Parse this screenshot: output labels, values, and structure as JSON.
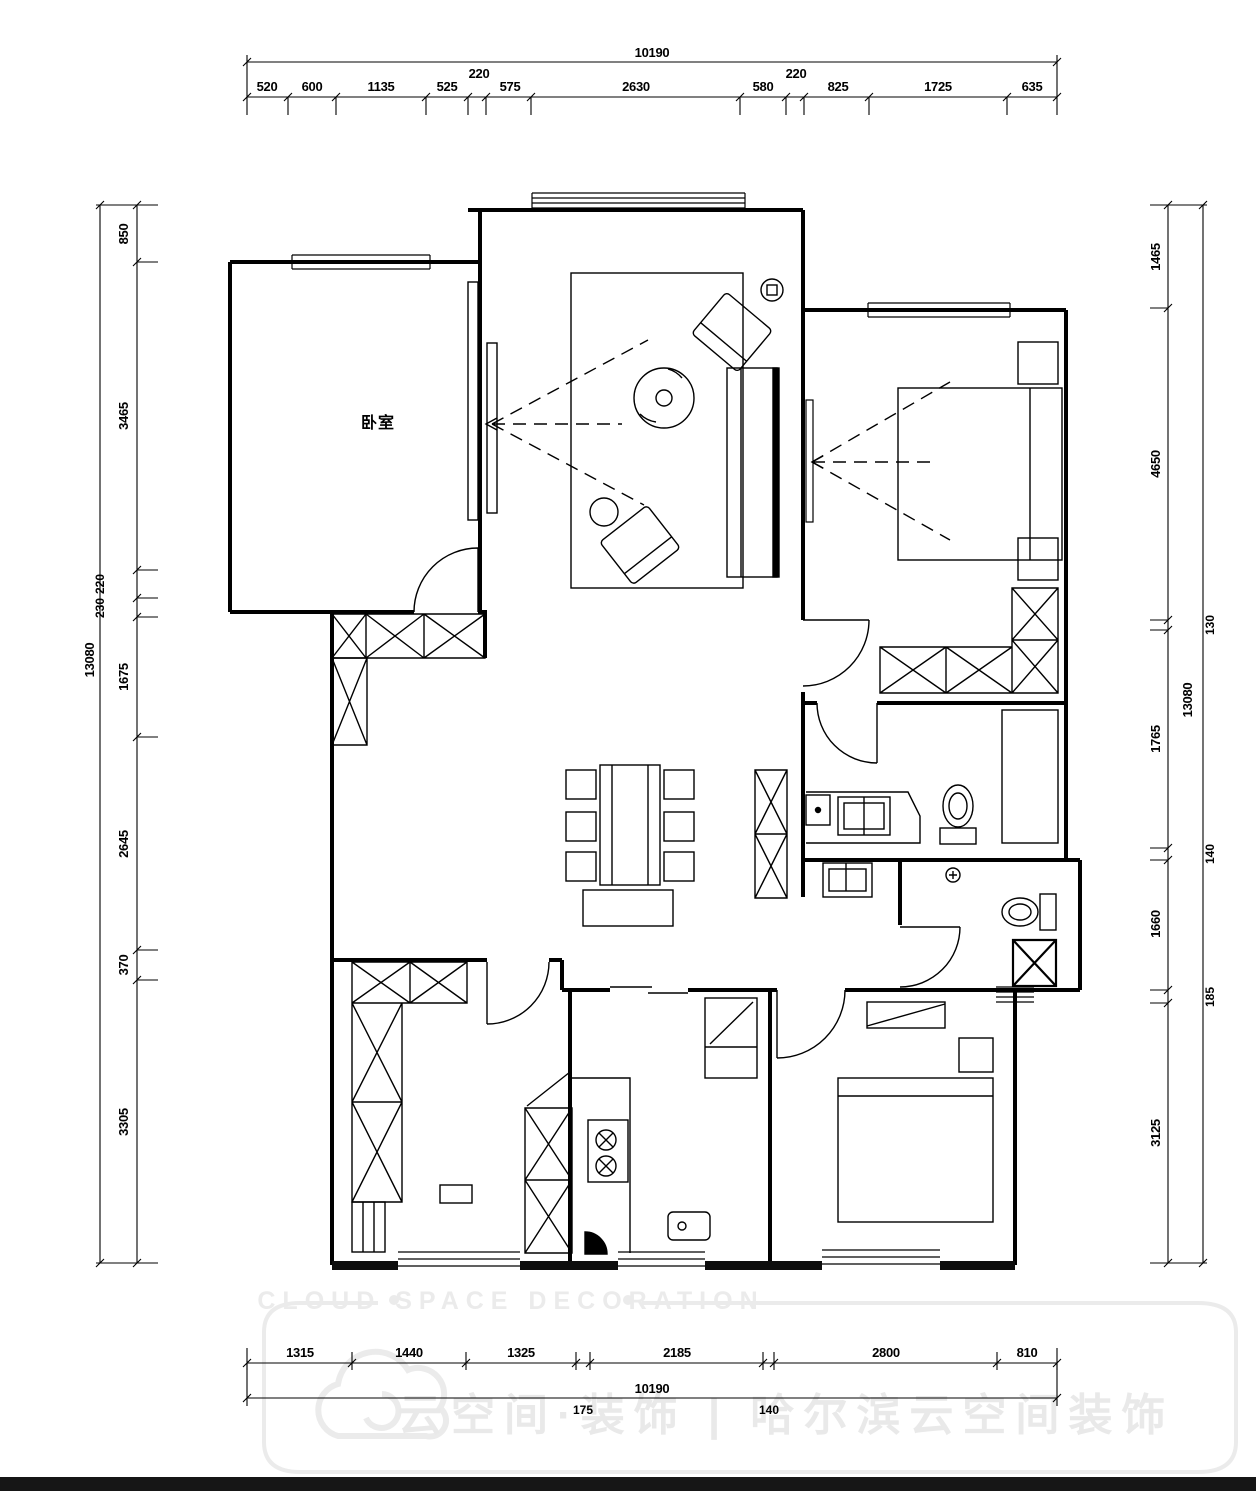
{
  "plan": {
    "room_label": "卧室"
  },
  "dimensions": {
    "top": {
      "total": "10190",
      "segments": [
        "520",
        "600",
        "1135",
        "525",
        "220",
        "575",
        "2630",
        "580",
        "220",
        "825",
        "1725",
        "635"
      ]
    },
    "bottom": {
      "total": "10190",
      "segments": [
        "1315",
        "1440",
        "1325",
        "175",
        "2185",
        "140",
        "2800",
        "810"
      ]
    },
    "left": {
      "total": "13080",
      "segments": [
        "850",
        "3465",
        "220",
        "230",
        "1675",
        "2645",
        "370",
        "3305"
      ]
    },
    "right": {
      "total": "13080",
      "segments": [
        "1465",
        "4650",
        "130",
        "1765",
        "140",
        "1660",
        "185",
        "3125"
      ]
    }
  },
  "watermark": {
    "en": "CLOUD SPACE DECORATION",
    "bullet": "●",
    "zh": "云空间·装饰 | 哈尔滨云空间装饰"
  },
  "colors": {
    "line": "#000000",
    "watermark": "#ebebeb",
    "bottom_bar": "#161616",
    "background": "#ffffff"
  }
}
